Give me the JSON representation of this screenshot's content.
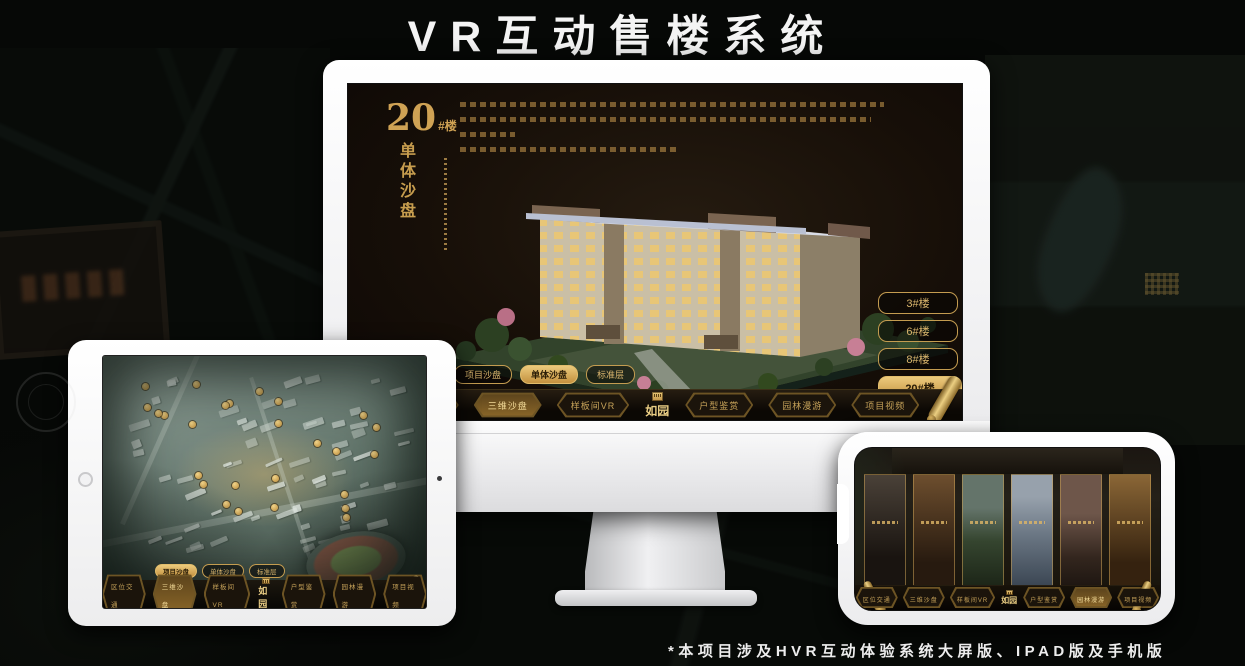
{
  "page": {
    "title": "VR互动售楼系统",
    "footnote": "*本项目涉及HVR互动体验系统大屏版、IPAD版及手机版"
  },
  "colors": {
    "gold_accent": "#d4af6e",
    "gold_active_fill": "#e0b968",
    "screen_background": "#181108",
    "page_background": "#060806"
  },
  "monitor": {
    "headline": {
      "number": "20",
      "suffix": "#楼",
      "subtitle_vertical": "单体沙盘"
    },
    "floor_buttons": [
      {
        "label": "3#楼",
        "active": false
      },
      {
        "label": "6#楼",
        "active": false
      },
      {
        "label": "8#楼",
        "active": false
      },
      {
        "label": "20#楼",
        "active": true
      }
    ],
    "tabs": [
      {
        "label": "项目沙盘",
        "active": false
      },
      {
        "label": "单体沙盘",
        "active": true
      },
      {
        "label": "标准层",
        "active": false
      }
    ],
    "nav": {
      "logo": "如园",
      "items_left": [
        {
          "label": "区位交通",
          "active": false
        },
        {
          "label": "三维沙盘",
          "active": true
        },
        {
          "label": "样板间VR",
          "active": false
        }
      ],
      "items_right": [
        {
          "label": "户型鉴赏",
          "active": false
        },
        {
          "label": "园林漫游",
          "active": false
        },
        {
          "label": "项目视频",
          "active": false
        }
      ]
    }
  },
  "ipad": {
    "tabs": [
      {
        "label": "项目沙盘",
        "active": true
      },
      {
        "label": "单体沙盘",
        "active": false
      },
      {
        "label": "标准层",
        "active": false
      }
    ],
    "nav": {
      "logo": "如园",
      "items_left": [
        {
          "label": "区位交通",
          "active": false
        },
        {
          "label": "三维沙盘",
          "active": true
        },
        {
          "label": "样板间VR",
          "active": false
        }
      ],
      "items_right": [
        {
          "label": "户型鉴赏",
          "active": false
        },
        {
          "label": "园林漫游",
          "active": false
        },
        {
          "label": "项目视频",
          "active": false
        }
      ]
    }
  },
  "phone": {
    "nav": {
      "logo": "如园",
      "items_left": [
        {
          "label": "区位交通",
          "active": false
        },
        {
          "label": "三维沙盘",
          "active": false
        },
        {
          "label": "样板间VR",
          "active": false
        }
      ],
      "items_right": [
        {
          "label": "户型鉴赏",
          "active": false
        },
        {
          "label": "园林漫游",
          "active": true
        },
        {
          "label": "项目视频",
          "active": false
        }
      ]
    }
  }
}
